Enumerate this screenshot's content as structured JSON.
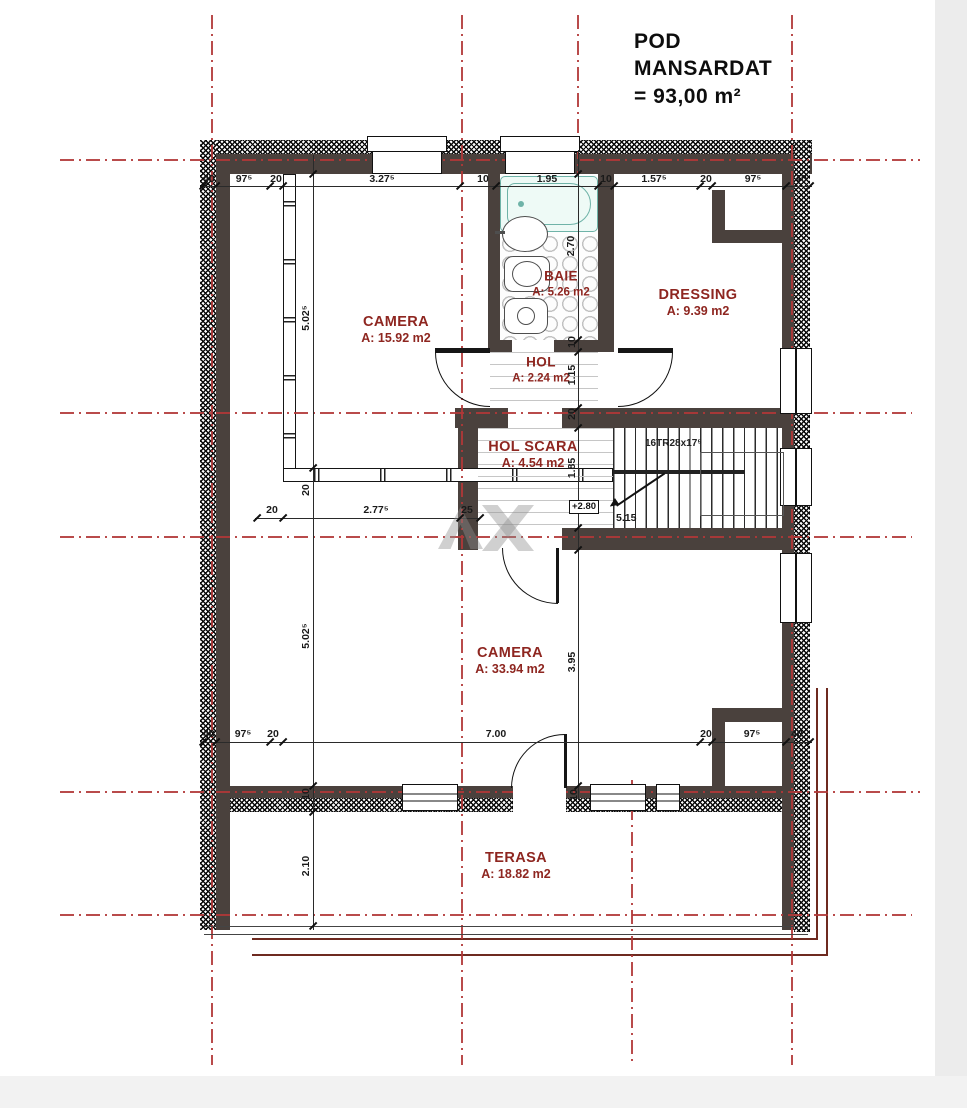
{
  "title_lines": [
    "POD",
    "MANSARDAT",
    "= 93,00 m²"
  ],
  "rooms": {
    "camera1": {
      "name": "CAMERA",
      "area": "A: 15.92 m2"
    },
    "baie": {
      "name": "BAIE",
      "area": "A: 5.26 m2"
    },
    "dressing": {
      "name": "DRESSING",
      "area": "A: 9.39 m2"
    },
    "hol": {
      "name": "HOL",
      "area": "A: 2.24 m2"
    },
    "hol_scara": {
      "name": "HOL SCARA",
      "area": "A: 4.54 m2"
    },
    "camera2": {
      "name": "CAMERA",
      "area": "A: 33.94 m2"
    },
    "terasa": {
      "name": "TERASA",
      "area": "A: 18.82 m2"
    }
  },
  "stairs": {
    "label": "16TR28x17⁵",
    "level_marker": "+2.80",
    "run_dim": "5.15"
  },
  "dims": {
    "top": [
      "40",
      "97⁵",
      "20",
      "3.27⁵",
      "10",
      "1.95",
      "10",
      "1.57⁵",
      "20",
      "97⁵",
      "40"
    ],
    "bottom": [
      "40",
      "97⁵",
      "20",
      "7.00",
      "20",
      "97⁵",
      "40"
    ],
    "mid": [
      "20",
      "2.77⁵",
      "25"
    ],
    "left": [
      "5.02⁵",
      "20",
      "5.02⁵",
      "2.10",
      "10"
    ],
    "right": [
      "2.70",
      "10",
      "1.15",
      "20",
      "1.85",
      "3.95",
      "10"
    ]
  },
  "colors": {
    "axis": "#b13737",
    "wall": "#4a413d",
    "label": "#8e2620",
    "tub": "#6fb3a8"
  }
}
